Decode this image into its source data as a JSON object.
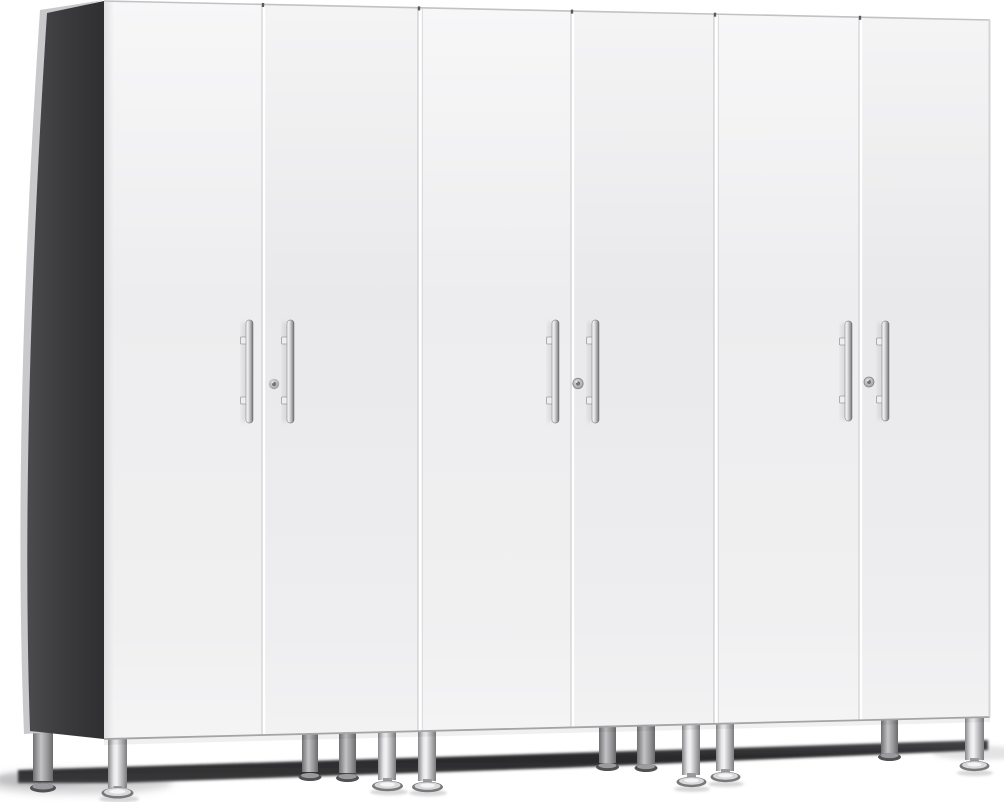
{
  "scene": {
    "type": "product-photo",
    "description": "Three tall two-door white cabinets standing side by side on silver adjustable feet, viewed from the front-left so the dark charcoal left side panel is visible; chrome vertical bar pulls and a round lock on each cabinet; dark shadow band on the floor beneath."
  },
  "product": {
    "name": "3-Piece White Tall Garage Cabinet Set",
    "cabinet_count": 3,
    "doors_per_cabinet": 2,
    "door_finish": "white",
    "side_panel_finish": "charcoal gray",
    "handle_style": "vertical chrome bar pull",
    "handles_visible": 6,
    "locks_visible": 3,
    "legs_visible": 12,
    "leg_style": "silver cylindrical leg with adjustable chrome foot"
  },
  "colors": {
    "background": "#ffffff",
    "door-face": "#ececee",
    "door-face-top": "#f6f6f7",
    "seam-highlight": "#ffffff",
    "seam-shadow": "#d0d0d2",
    "top-edge": "#c2c2c4",
    "bottom-edge": "#a4a4a6",
    "side-panel": "#3b3b3d",
    "side-panel-edge": "#c9c9cb",
    "handle-chrome": "#d9d9db",
    "handle-dark": "#737375",
    "lock-gray": "#a6a6a8",
    "leg-silver": "#c6c6c8",
    "foot-chrome": "#dcdcde",
    "shadow-band": "#2d2d2f",
    "floor-shadow": "#c5c5c7"
  }
}
